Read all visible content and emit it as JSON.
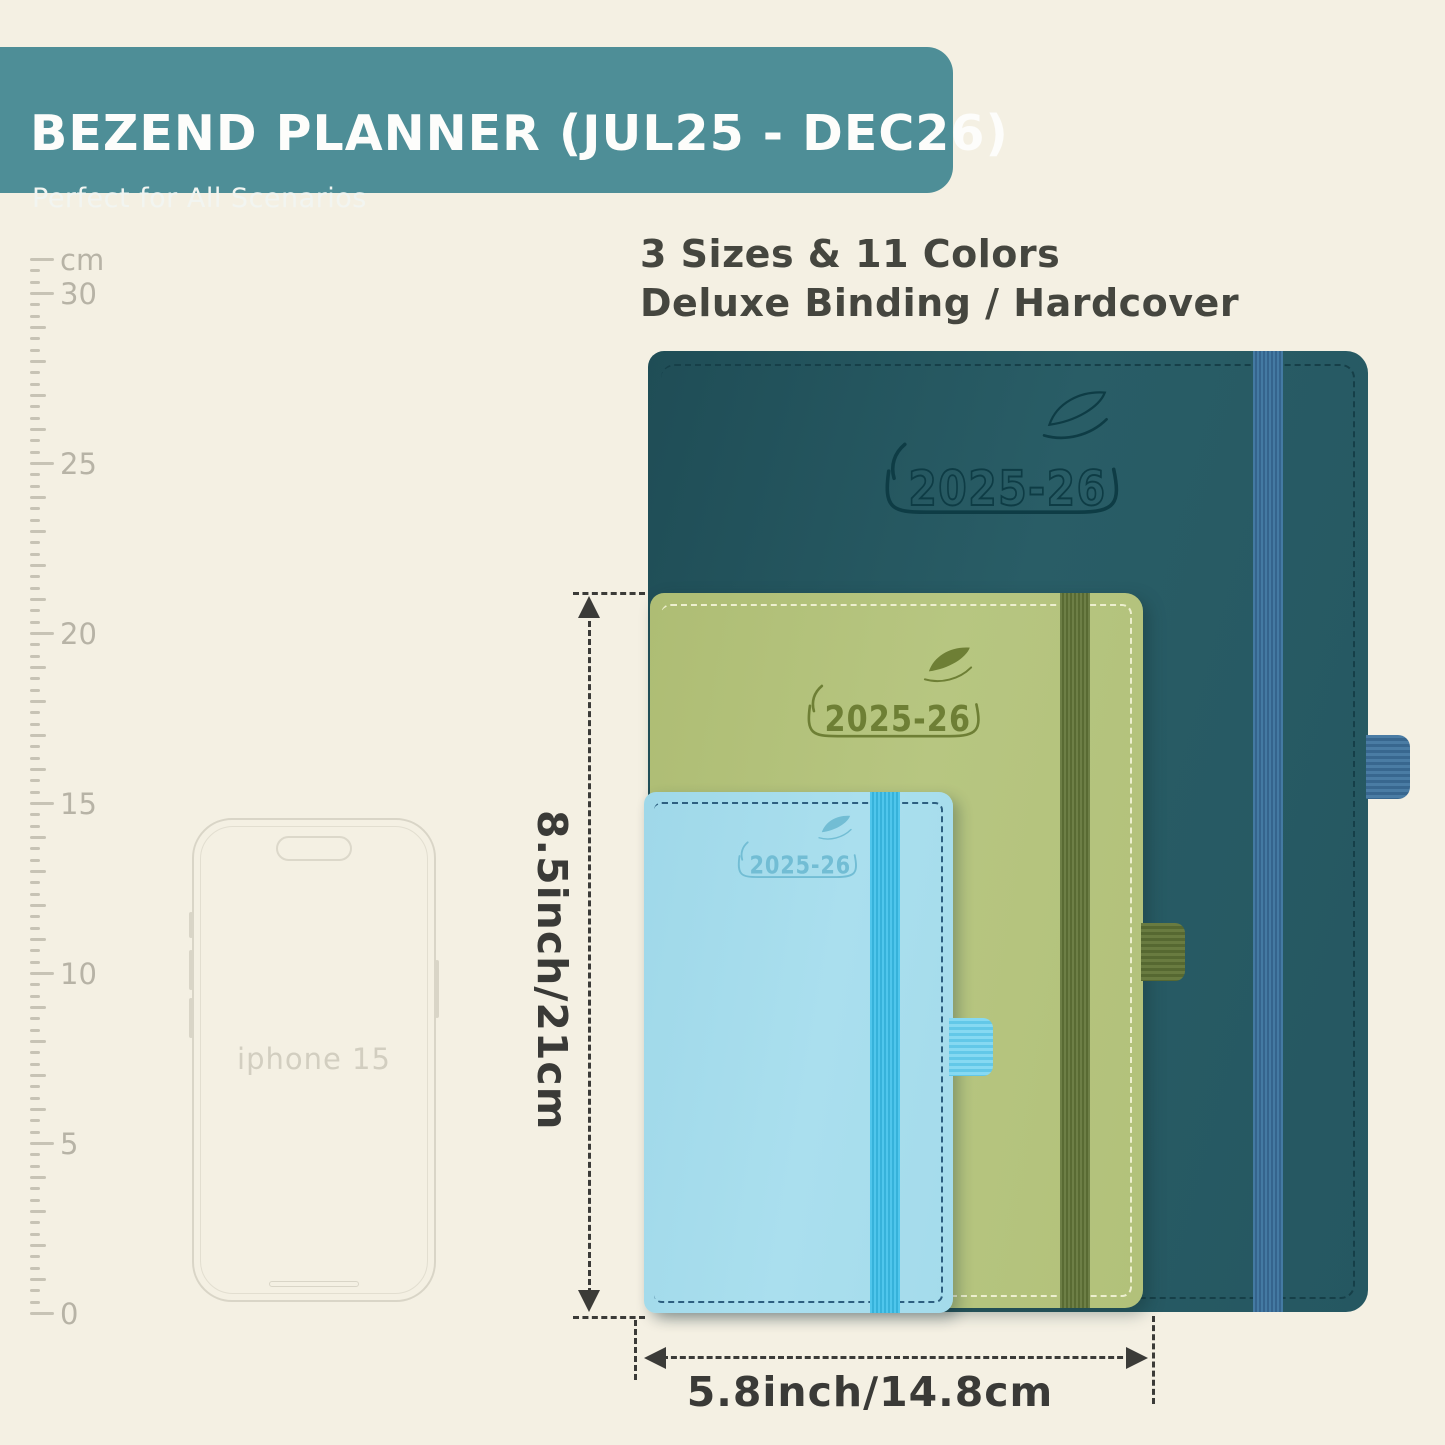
{
  "banner": {
    "title": "BEZEND PLANNER (JUL25 - DEC26)",
    "subtitle": "Perfect for All Scenarios",
    "bg_color": "#4e8e97",
    "text_color": "#ffffff"
  },
  "info": {
    "line1": "3 Sizes & 11 Colors",
    "line2": "Deluxe Binding / Hardcover"
  },
  "ruler": {
    "unit": "cm",
    "max_cm": 31,
    "cm_spacing_px": 34,
    "label_rows": [
      {
        "cm": 31,
        "value": "cm"
      },
      {
        "cm": 30,
        "value": "30"
      },
      {
        "cm": 25,
        "value": "25"
      },
      {
        "cm": 20,
        "value": "20"
      },
      {
        "cm": 15,
        "value": "15"
      },
      {
        "cm": 10,
        "value": "10"
      },
      {
        "cm": 5,
        "value": "5"
      },
      {
        "cm": 0,
        "value": "0"
      }
    ]
  },
  "phone": {
    "label": "iphone 15"
  },
  "planners": {
    "large": {
      "size": "large",
      "year": "2025-26",
      "cover_color": "#275a63",
      "band_color": "#40739c",
      "emboss_color": "#0e3c45"
    },
    "medium": {
      "size": "medium",
      "year": "2025-26",
      "cover_color": "#b5c57e",
      "band_color": "#66783f",
      "emboss_color": "#6e7f35"
    },
    "small": {
      "size": "small",
      "year": "2025-26",
      "cover_color": "#a6dcec",
      "band_color": "#46c2e9",
      "emboss_color": "#72bdd4"
    }
  },
  "dimensions": {
    "height_label": "8.5inch/21cm",
    "width_label": "5.8inch/14.8cm"
  }
}
